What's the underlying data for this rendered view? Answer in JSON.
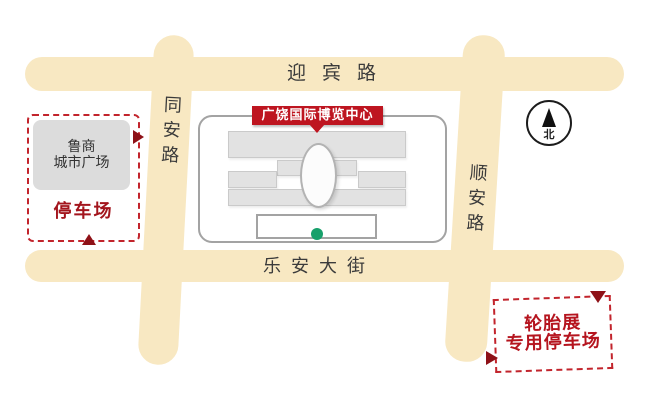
{
  "roads": {
    "top": "迎宾路",
    "left": "同安路",
    "right": "顺安路",
    "bottom": "乐安大街"
  },
  "expo": {
    "label": "广饶国际博览中心"
  },
  "plaza": {
    "line1": "鲁商",
    "line2": "城市广场"
  },
  "parking_left": {
    "label": "停车场"
  },
  "parking_tire": {
    "line1": "轮胎展",
    "line2": "专用停车场"
  },
  "compass": {
    "north": "北"
  },
  "colors": {
    "road": "#F8E8C2",
    "label_red": "#BE1520",
    "text_red": "#A3151D",
    "marker_red": "#8E1117",
    "dashed_border_red": "#C2242C",
    "building_gray": "#E2E2E2",
    "plaza_gray": "#DCDCDC",
    "green_dot": "#17A06B",
    "road_text": "#3B3B3B"
  }
}
